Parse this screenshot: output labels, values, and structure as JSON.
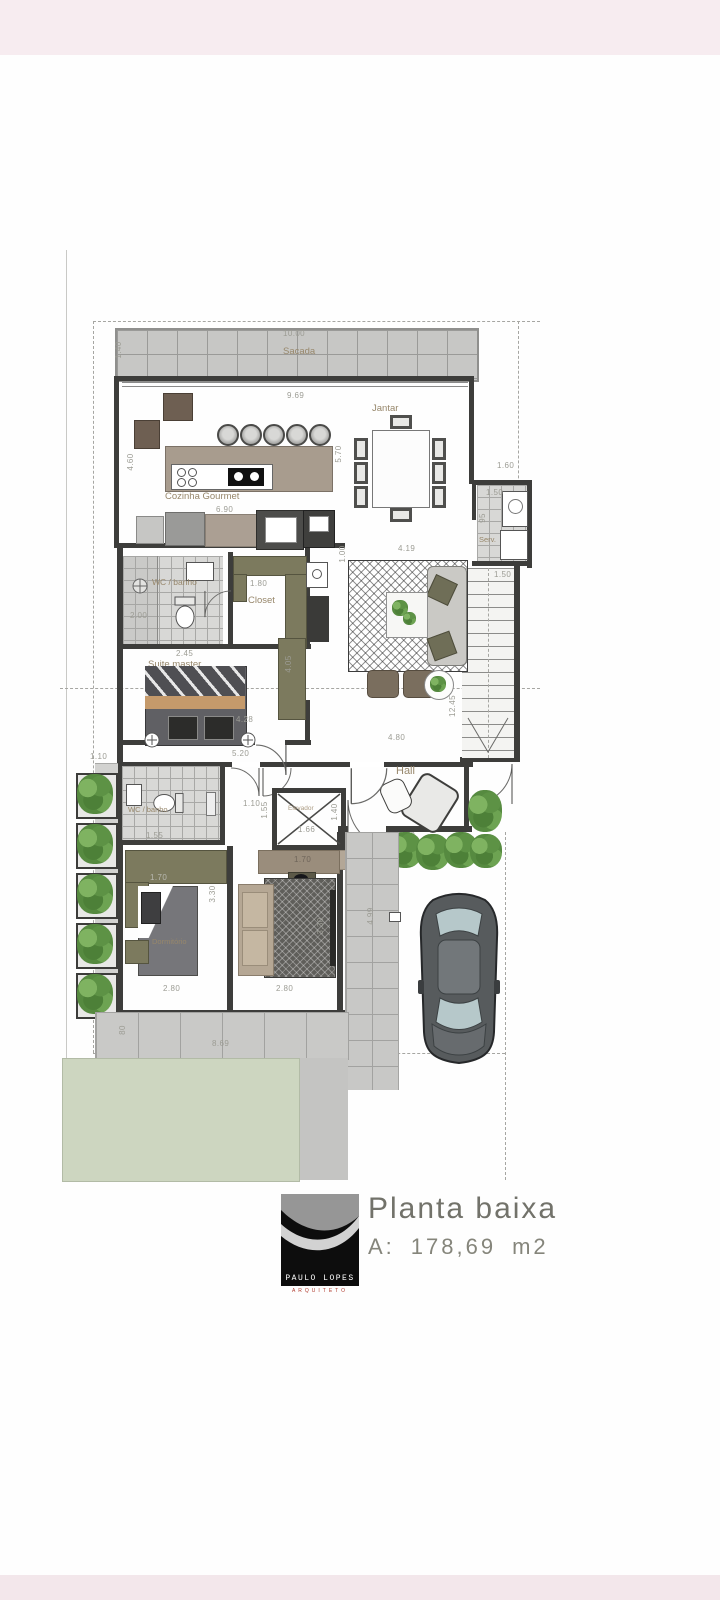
{
  "title_block": {
    "title": "Planta baixa",
    "area_label": "A:",
    "area_value": "178,69",
    "area_unit": "m2",
    "logo_text": "PAULO LOPES",
    "logo_subtext": "ARQUITETO"
  },
  "labels": {
    "sacada": "Sacada",
    "cozinha": "Cozinha Gourmet",
    "jantar": "Jantar",
    "serv": "Serv.",
    "closet": "Closet",
    "wc_suite": "WC / banho",
    "suite": "Suite master",
    "hall": "Hall",
    "elevador": "Elevador",
    "wc_social": "WC / banho",
    "dormitorio": "Dormitório"
  },
  "dims": {
    "sacada_w": "10.00",
    "sacada_d": "1.40",
    "varanda_w": "9.69",
    "cozinha_h": "4.60",
    "island_s": "5.70",
    "cozinha_w": "6.90",
    "serv_top": "1.60",
    "serv_w": "1.50",
    "serv_d": "95",
    "stair_w": "1.50",
    "stair_len": "12.45",
    "estar_s": "1.00",
    "estar_w": "4.19",
    "wc_suite_w": "2.00",
    "closet_w": "1.80",
    "wc_suite_b": "2.45",
    "suite_w": "4.28",
    "suite_cab": "4.05",
    "corr_w": "5.20",
    "hall_w": "4.80",
    "hall_front": "5.78",
    "door_a": "1.10",
    "door_b": "1.10",
    "wc_social_w": "1.55",
    "elev_w": "1.66",
    "elev_d": "1.40",
    "elev_s": "1.55",
    "elev_b": "1.70",
    "ward1": "1.70",
    "ward2": "1.70",
    "dorm1_w": "2.80",
    "dorm2_w": "2.80",
    "dorm1_d": "3.30",
    "dorm2_d": "3.30",
    "walk_w": "1.10",
    "walk_len": "6.50",
    "calcada_d": "80",
    "calcada_w": "8.69",
    "entry_w": "1.50",
    "entry_s": "50",
    "drive_len": "4.99"
  },
  "colors": {
    "wall": "#3d3d3b",
    "olive": "#7c7a5e",
    "tan": "#a89c8e",
    "lawn": "#cdd6c0",
    "plant": "#568a40",
    "page_band": "#f7ecf0",
    "accent_red": "#b03a2e"
  }
}
